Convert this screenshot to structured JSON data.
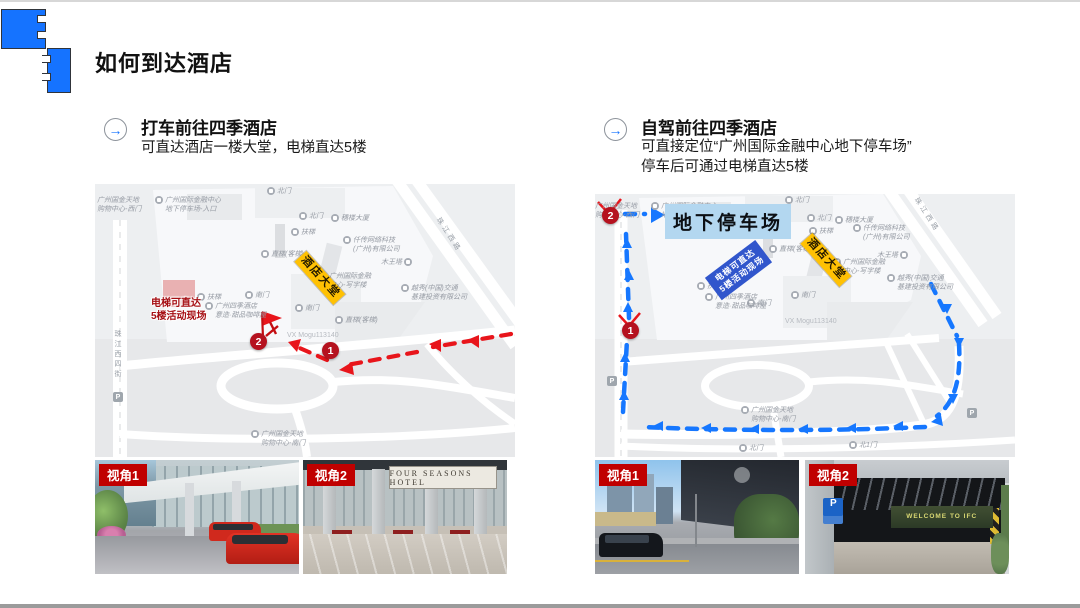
{
  "slide": {
    "title": "如何到达酒店"
  },
  "icons": {
    "section_arrow": "→"
  },
  "colors": {
    "accent_blue": "#1774ff",
    "route_red": "#e8151b",
    "route_blue": "#1677ff",
    "badge_red": "#c00000",
    "lobby_yellow": "#ffc103",
    "parking_highlight": "#b3d7f0",
    "elevator_blue": "#3156cc"
  },
  "taxi": {
    "heading": "打车前往四季酒店",
    "subheading": "可直达酒店一楼大堂，电梯直达5楼",
    "map": {
      "marker1": "1",
      "marker2": "2",
      "lobby": "酒店大堂",
      "note": "电梯可直达\n5楼活动现场",
      "watermark": "VX Mogu113140",
      "street_left": "珠江西四街",
      "street_diag": "珠江西路",
      "p_label": "P",
      "labels": [
        {
          "text": "广州国金天地\n购物中心-西门"
        },
        {
          "text": "广州国际金融中心\n地下停车场-入口"
        },
        {
          "text": "北门"
        },
        {
          "text": "北门"
        },
        {
          "text": "穗楼大厦"
        },
        {
          "text": "扶梯"
        },
        {
          "text": "仟传网络科技\n(广州)有限公司"
        },
        {
          "text": "直梯(客梯)"
        },
        {
          "text": "广州国际金融\n中心-写字楼"
        },
        {
          "text": "木王塔"
        },
        {
          "text": "越秀(中国)交通\n基建投资有限公司"
        },
        {
          "text": "南门"
        },
        {
          "text": "南门"
        },
        {
          "text": "扶梯"
        },
        {
          "text": "直梯(客梯)"
        },
        {
          "text": "广州四季酒店\n意造·甜品咖啡屋"
        },
        {
          "text": "广州国金天地\n购物中心-南门"
        }
      ]
    },
    "photos": [
      {
        "badge": "视角1"
      },
      {
        "badge": "视角2",
        "sign": "FOUR SEASONS HOTEL"
      }
    ]
  },
  "drive": {
    "heading": "自驾前往四季酒店",
    "sub1": "可直接定位“广州国际金融中心地下停车场”",
    "sub2": "停车后可通过电梯直达5楼",
    "map": {
      "marker1": "1",
      "marker2": "2",
      "parking": "地下停车场",
      "elevator": "电梯可直达\n5楼活动现场",
      "lobby": "酒店大堂",
      "watermark": "VX Mogu113140",
      "street_diag": "珠江西路",
      "p_label": "P",
      "labels": [
        {
          "text": "广州国金天地\n购物中心-西门"
        },
        {
          "text": "北门"
        },
        {
          "text": "北门"
        },
        {
          "text": "穗楼大厦"
        },
        {
          "text": "扶梯"
        },
        {
          "text": "仟传网络科技\n(广州)有限公司"
        },
        {
          "text": "直梯(客梯)"
        },
        {
          "text": "广州国际金融\n中心-写字楼"
        },
        {
          "text": "木王塔"
        },
        {
          "text": "越秀(中国)交通\n基建投资有限公司"
        },
        {
          "text": "南门"
        },
        {
          "text": "南门"
        },
        {
          "text": "扶梯"
        },
        {
          "text": "广州四季酒店\n意造·甜品咖啡屋"
        },
        {
          "text": "广州国金天地\n购物中心-南门"
        },
        {
          "text": "北门"
        },
        {
          "text": "北1门"
        },
        {
          "text": "广州国际金融中心\n地下停车场-入口"
        }
      ]
    },
    "photos": [
      {
        "badge": "视角1"
      },
      {
        "badge": "视角2",
        "sign": "WELCOME TO IFC",
        "p": "P"
      }
    ]
  }
}
